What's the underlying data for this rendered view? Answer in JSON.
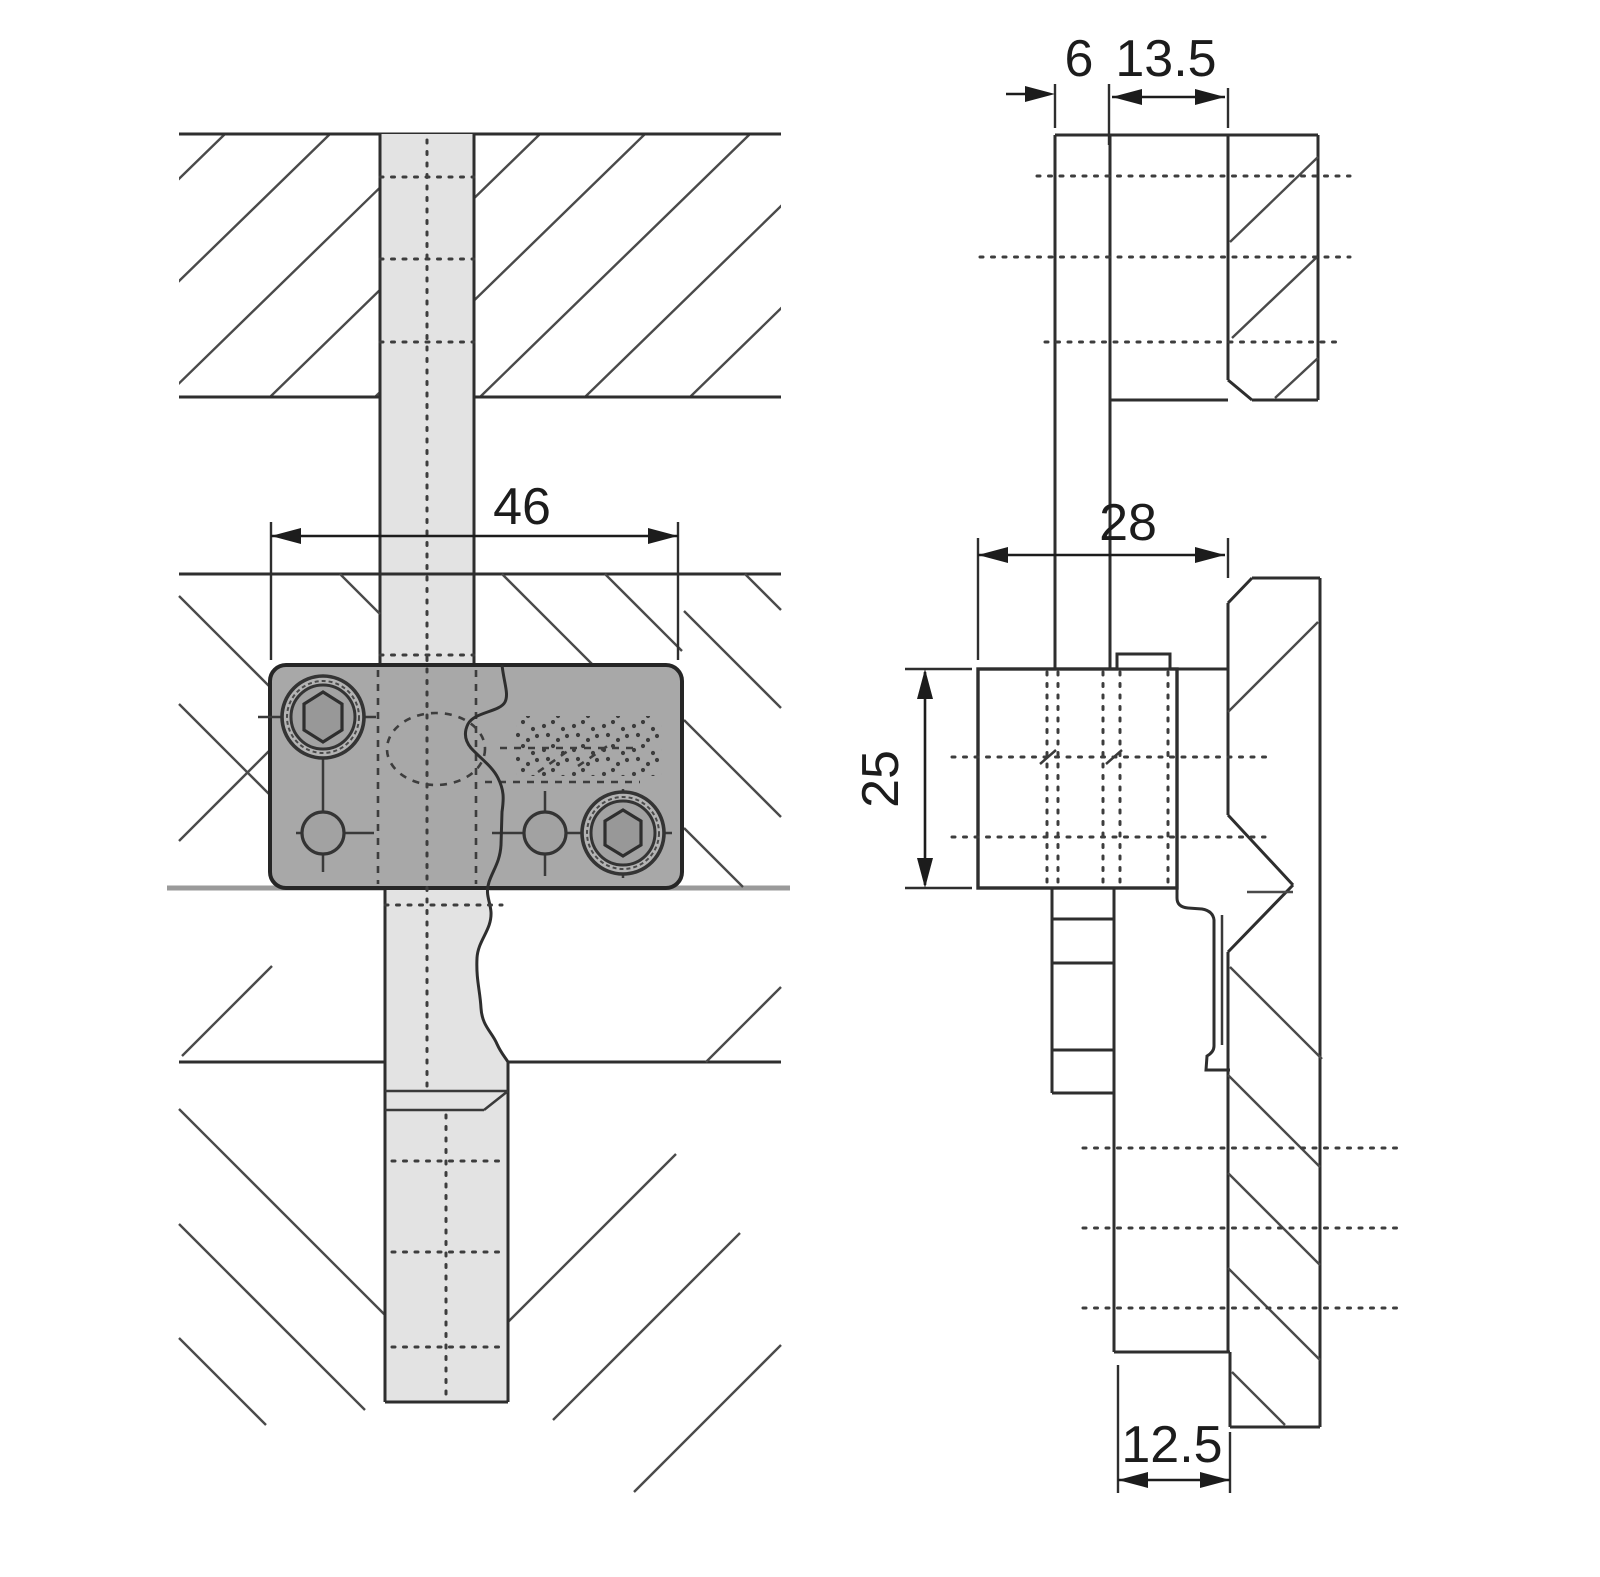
{
  "diagram": {
    "type": "technical-drawing",
    "subject": "cabinet panel connector fitting - sectional front view and side view",
    "views": {
      "front": {
        "name": "front-section-view",
        "parts": [
          "top-panel-section",
          "vertical-dowel-bar",
          "mounting-plate",
          "lower-panel-section"
        ],
        "plate_screws": [
          "hex-socket-screw-top-left",
          "pilot-hole-left",
          "pilot-hole-right",
          "hex-socket-screw-bottom-right"
        ]
      },
      "side": {
        "name": "side-section-view",
        "parts": [
          "panel-strip",
          "spacer-block",
          "wall-panel-top",
          "fitting-body",
          "hook-bracket",
          "wall-panel-bottom",
          "dowel-ladder"
        ]
      }
    },
    "dimension_labels": {
      "plate_width": "46",
      "panel_thickness": "6",
      "offset_depth": "13.5",
      "body_depth": "28",
      "body_height": "25",
      "bottom_inset": "12.5"
    },
    "colors": {
      "background": "#ffffff",
      "plate_fill": "#a8a8a8",
      "plate_border": "#262626",
      "bar_fill": "#e3e3e3",
      "line": "#2e2e2e",
      "thick_gray_line": "#9a9a9a",
      "dim_text": "#1c1c1c"
    }
  }
}
